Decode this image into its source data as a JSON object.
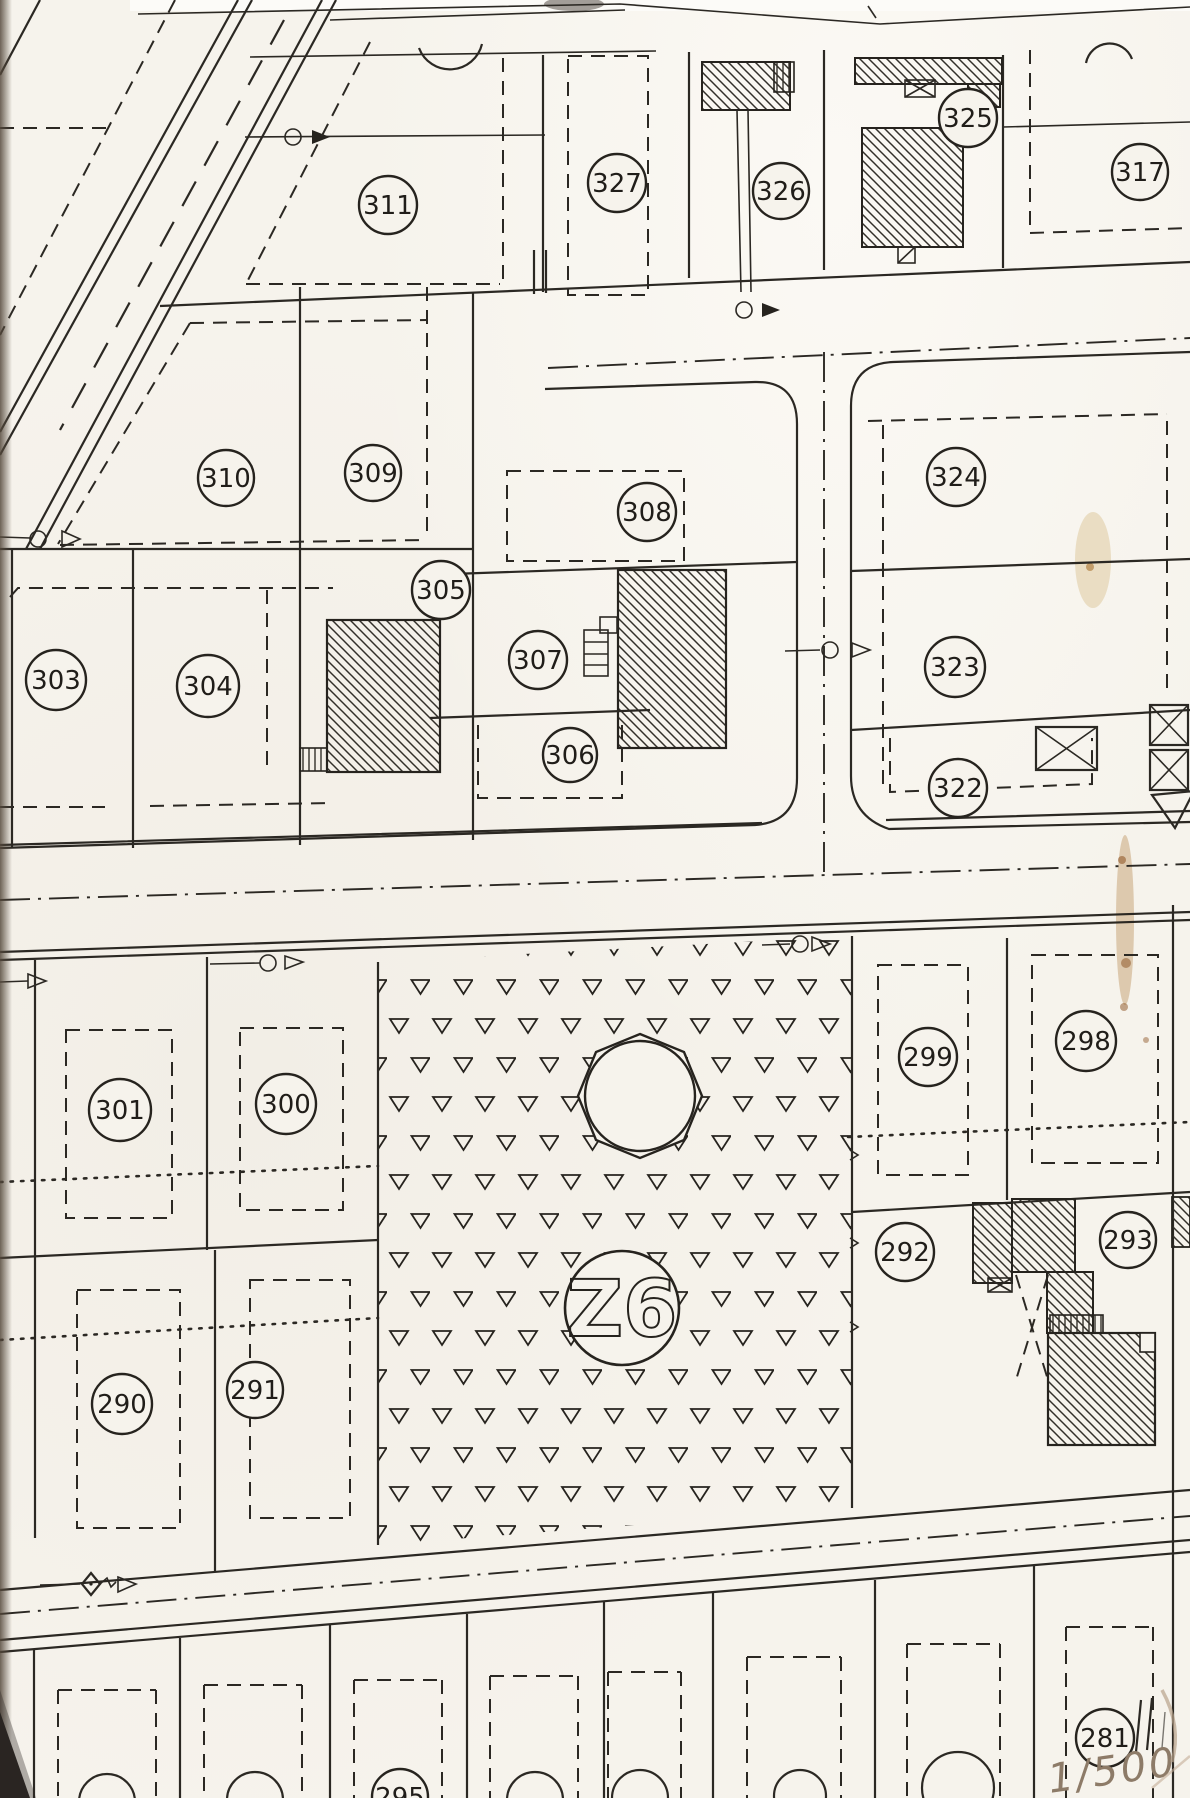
{
  "document": {
    "kind": "scanned cadastral parcel plan",
    "scale_note": "1/500"
  },
  "zone": {
    "label": "Z6"
  },
  "parcels": [
    {
      "label": "311"
    },
    {
      "label": "327"
    },
    {
      "label": "326"
    },
    {
      "label": "325"
    },
    {
      "label": "317"
    },
    {
      "label": "310"
    },
    {
      "label": "309"
    },
    {
      "label": "324"
    },
    {
      "label": "308"
    },
    {
      "label": "305"
    },
    {
      "label": "303"
    },
    {
      "label": "304"
    },
    {
      "label": "307"
    },
    {
      "label": "323"
    },
    {
      "label": "306"
    },
    {
      "label": "322"
    },
    {
      "label": "301"
    },
    {
      "label": "300"
    },
    {
      "label": "299"
    },
    {
      "label": "298"
    },
    {
      "label": "292"
    },
    {
      "label": "293"
    },
    {
      "label": "290"
    },
    {
      "label": "291"
    },
    {
      "label": "281"
    },
    {
      "label": "295"
    }
  ]
}
